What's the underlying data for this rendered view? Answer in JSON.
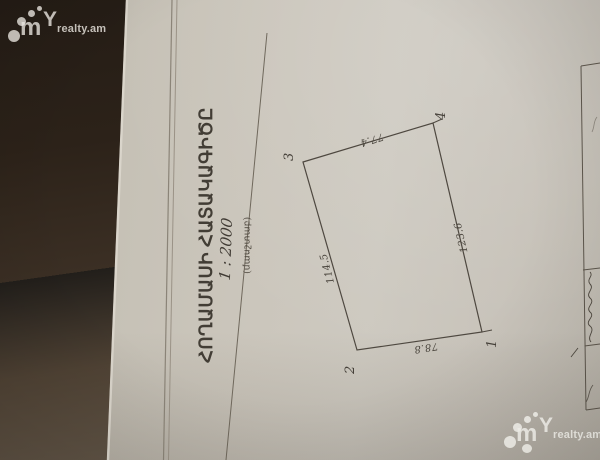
{
  "brand": {
    "m": "m",
    "y": "Y",
    "text": "realty.am"
  },
  "document": {
    "title": "ՀՈՂԱՄԱՍԻ ՀԱՏԱԿԱԳԻԾԸ",
    "scale_value": "1 : 2000",
    "scale_label": "(մասշտաբ)"
  },
  "plot": {
    "vertices": [
      {
        "label": "1"
      },
      {
        "label": "2"
      },
      {
        "label": "3"
      },
      {
        "label": "4"
      }
    ],
    "edges": [
      {
        "between": "3-4",
        "length": "77.4"
      },
      {
        "between": "4-1",
        "length": "123.6"
      },
      {
        "between": "3-2",
        "length": "114.5"
      },
      {
        "between": "2-1",
        "length": "78.8"
      }
    ]
  },
  "colors": {
    "paper": "#c9c4ba",
    "ink": "#4f4940",
    "background": "#3a2e23",
    "watermark": "#f2efe9"
  }
}
